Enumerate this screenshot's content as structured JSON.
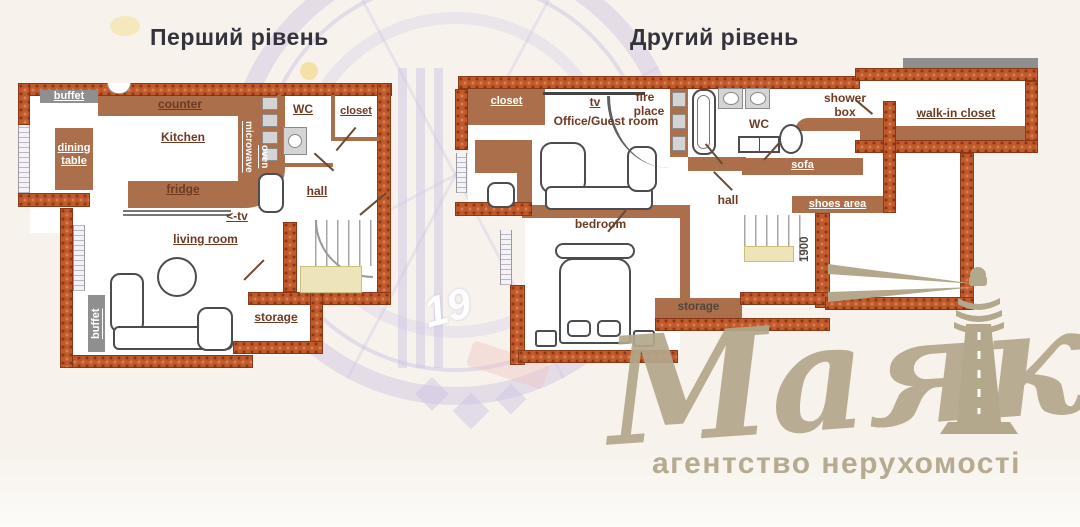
{
  "page": {
    "title_level1": "Перший рівень",
    "title_level2": "Другий рівень"
  },
  "level1": {
    "buffet_top": "buffet",
    "dining_table": "dining table",
    "counter": "counter",
    "kitchen": "Kitchen",
    "microwave": "microwave",
    "oven": "oven",
    "fridge": "fridge",
    "tv_arrow": "<-tv",
    "wc": "WC",
    "closet": "closet",
    "hall": "hall",
    "living_room": "living room",
    "storage": "storage",
    "buffet_side": "buffet"
  },
  "level2": {
    "closet": "closet",
    "tv": "tv",
    "office_guest_room": "Office/Guest room",
    "fire_line1": "fire",
    "fire_line2": "place",
    "wc": "WC",
    "shower_line1": "shower",
    "shower_line2": "box",
    "walk_in_closet": "walk-in closet",
    "sofa": "sofa",
    "hall": "hall",
    "shoes_area": "shoes area",
    "bedroom": "bedroom",
    "storage": "storage",
    "stairs_height": "1900"
  },
  "watermark": {
    "brand": "Маяк",
    "tagline": "агентство нерухомості",
    "emblem_number": "19"
  },
  "colors": {
    "brick": "#c05a2b",
    "brick_dot": "#953c18",
    "wood": "#ab6f4c",
    "label": "#6e3a22",
    "label_gray": "#4e463c",
    "bar_gray": "#8f8f8f",
    "gold": "#b3a88c",
    "lavender": "#cfc5e3",
    "cream": "#f7f3ec",
    "stairs_yellow": "#eee4b9",
    "outline": "#4c4c50"
  }
}
